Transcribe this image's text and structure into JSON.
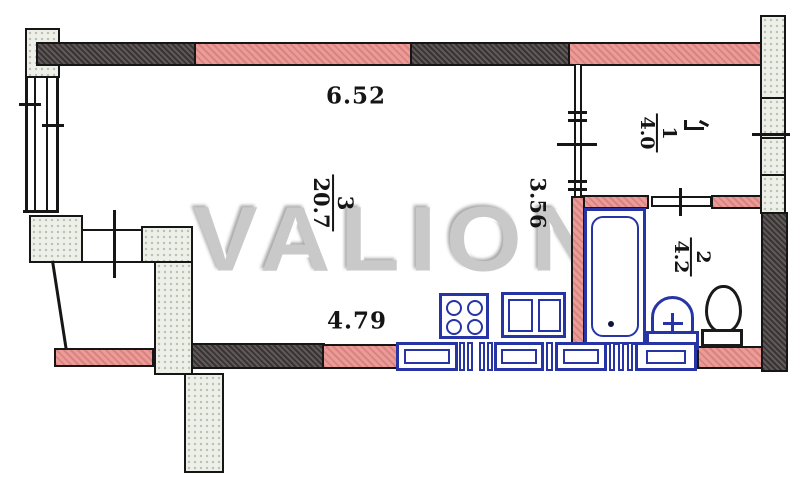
{
  "watermark": "VALION",
  "dimensions": {
    "top_width": "6.52",
    "bottom_width": "4.79",
    "height": "3.56"
  },
  "rooms": [
    {
      "number": "3",
      "area": "20.7",
      "name": "living-room"
    },
    {
      "number": "1",
      "area": "4.0",
      "name": "room-1"
    },
    {
      "number": "2",
      "area": "4.2",
      "name": "bathroom"
    }
  ],
  "fixtures": [
    "bathtub",
    "wash-basin",
    "toilet",
    "stove",
    "kitchen-sink",
    "kitchen-counters"
  ],
  "colors": {
    "wall_pink": "#eb9b98",
    "wall_dark": "#585050",
    "fixture_blue": "#2634a6",
    "stipple_fill": "#edefe9",
    "outline": "#161616",
    "watermark_gray": "#c9c9c9"
  }
}
